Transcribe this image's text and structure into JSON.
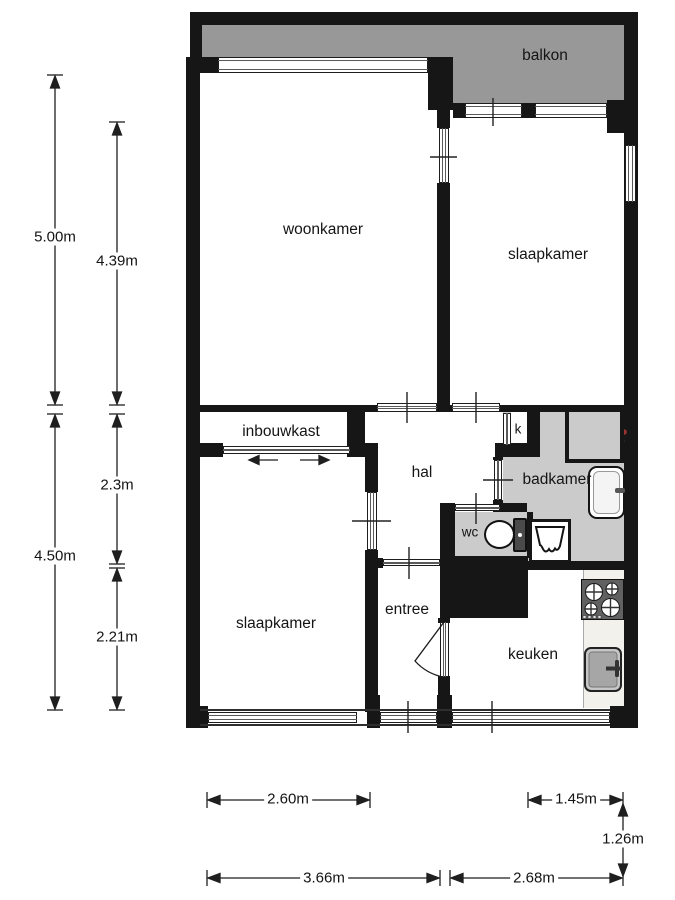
{
  "rooms": {
    "balkon": {
      "label": "balkon"
    },
    "woonkamer": {
      "label": "woonkamer"
    },
    "slaapkamer_top": {
      "label": "slaapkamer"
    },
    "inbouwkast": {
      "label": "inbouwkast"
    },
    "hal": {
      "label": "hal"
    },
    "kast": {
      "label": "k"
    },
    "badkamer": {
      "label": "badkamer"
    },
    "wc": {
      "label": "wc"
    },
    "entree": {
      "label": "entree"
    },
    "slaapkamer_bottom": {
      "label": "slaapkamer"
    },
    "keuken": {
      "label": "keuken"
    }
  },
  "dims": {
    "left_outer_top": {
      "label": "5.00m"
    },
    "left_inner_top": {
      "label": "4.39m"
    },
    "left_outer_bottom": {
      "label": "4.50m"
    },
    "left_inner_mid": {
      "label": "2.3m"
    },
    "left_inner_bottom": {
      "label": "2.21m"
    },
    "bottom_upper_left": {
      "label": "2.60m"
    },
    "bottom_upper_right": {
      "label": "1.45m"
    },
    "bottom_vertical": {
      "label": "1.26m"
    },
    "bottom_lower_left": {
      "label": "3.66m"
    },
    "bottom_lower_right": {
      "label": "2.68m"
    }
  },
  "fixtures": {
    "washer_drain": "drain-icon",
    "washer_tap": "tap-icon",
    "washbasin": "washbasin-icon",
    "shower": "shower-icon",
    "toilet": "toilet-icon",
    "stove": "stove-4-burner-icon",
    "kitchen_sink": "kitchen-sink-icon",
    "sliding_door": "left-right-arrows",
    "entry_door": "door-swing-arc"
  },
  "colors": {
    "wall": "#161616",
    "balcony_floor": "#989898",
    "bathroom_floor": "#cbcbcb",
    "counter": "#f2f1ec",
    "dimension_line": "#1f1f1f",
    "floor": "#ffffff"
  }
}
